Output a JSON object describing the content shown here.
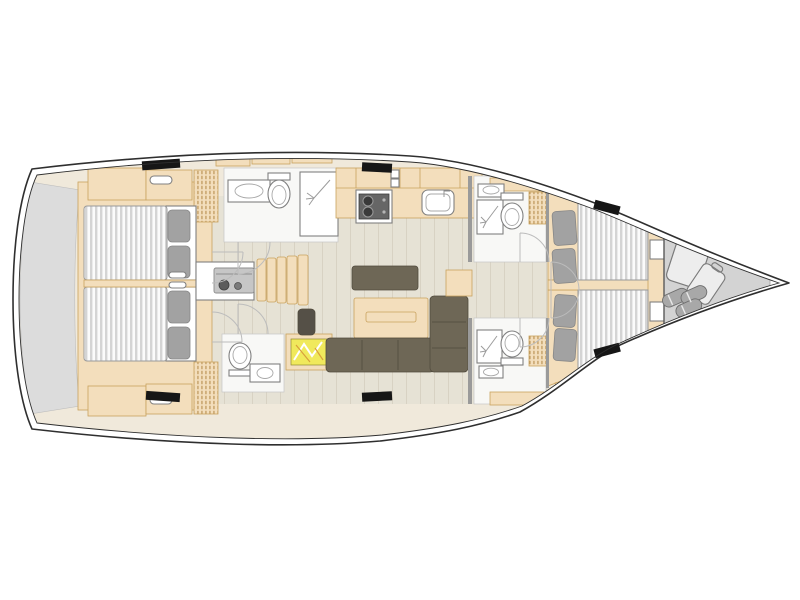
{
  "plan": {
    "description": "Sailing yacht interior floor plan, top view, bow pointing right, stern left",
    "orientation": {
      "bow": "right",
      "stern": "left"
    },
    "rooms": [
      "swim-platform",
      "aft-cabin-port",
      "aft-cabin-starboard",
      "aft-head-port",
      "aft-head-starboard",
      "companionway",
      "nav-station",
      "galley",
      "salon",
      "forward-head-port",
      "forward-head-starboard",
      "forward-cabin-port",
      "forward-cabin-starboard",
      "bow-sail-locker"
    ],
    "features": {
      "double_berths": 4,
      "heads": 4,
      "showers": 3,
      "hull_windows": 6,
      "galley_items": [
        "stove",
        "sink"
      ],
      "salon_items": [
        "table",
        "l-sofa",
        "bench"
      ],
      "bow_locker_items": [
        "suitcase",
        "suitcase",
        "fenders"
      ]
    }
  },
  "colors": {
    "hull_line": "#2f2f2f",
    "deck_white": "#ffffff",
    "interior_base": "#f0e9db",
    "wood": "#f3debc",
    "wood_line": "#c9a25e",
    "floor_plank": "#e6e2d5",
    "plank_line": "#d8d2c3",
    "mattress_stripe_light": "#fbfbfb",
    "mattress_stripe_dark": "#d4d4d4",
    "mattress_edge": "#9a9a9a",
    "pillow": "#a2a2a2",
    "sofa": "#6e6756",
    "stool": "#555047",
    "platform": "#dcdcdc",
    "locker": "#d3d3d3",
    "fixture_white": "#ffffff",
    "fixture_line": "#808080",
    "stove_dark": "#666666",
    "chart_yellow": "#f0e95c",
    "window_black": "#161616",
    "door_arc": "#bcbcbc",
    "wall": "#9a9a9a",
    "engine": "#c6c6c6",
    "luggage": "#ededed",
    "fender": "#a8a8a8"
  }
}
